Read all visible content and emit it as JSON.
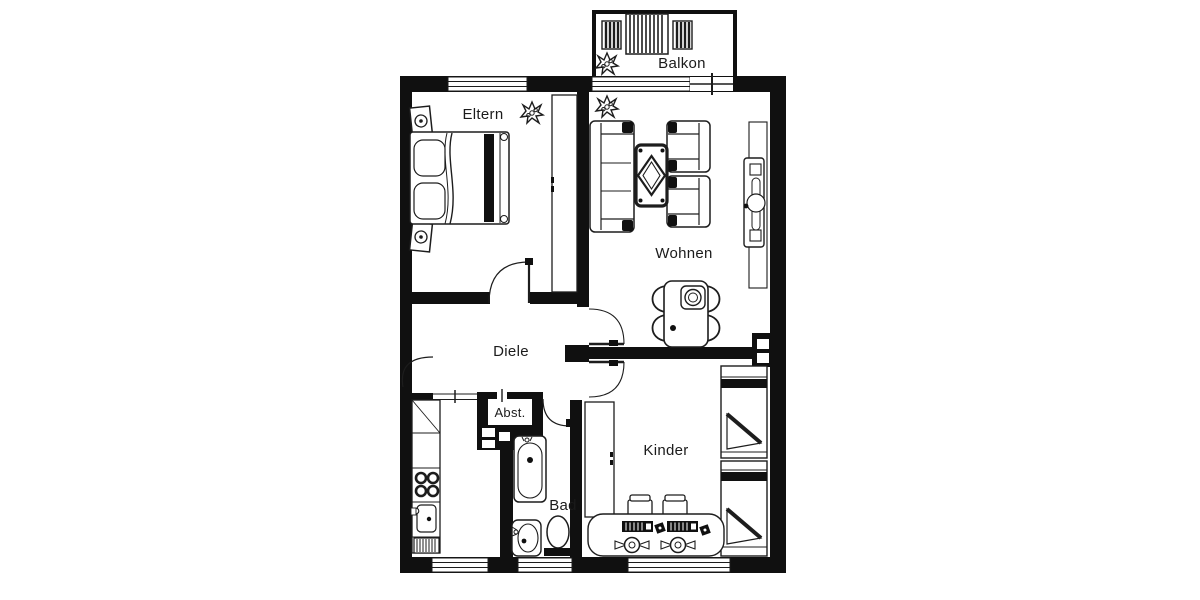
{
  "floorplan": {
    "rooms": {
      "eltern": {
        "label": "Eltern"
      },
      "balkon": {
        "label": "Balkon"
      },
      "wohnen": {
        "label": "Wohnen"
      },
      "diele": {
        "label": "Diele"
      },
      "abst": {
        "label": "Abst."
      },
      "bad": {
        "label": "Bad"
      },
      "kinder": {
        "label": "Kinder"
      }
    },
    "colors": {
      "wall": "#101010",
      "line": "#1d1d1d",
      "background": "#ffffff"
    },
    "icons": {
      "plant": "plant-icon",
      "speaker": "speaker-icon"
    }
  }
}
